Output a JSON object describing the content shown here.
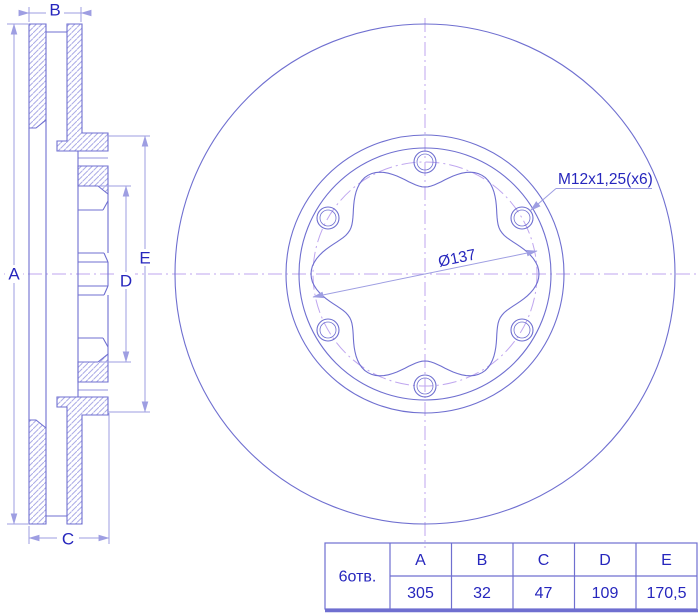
{
  "section_view": {
    "labels": {
      "a": "A",
      "b": "B",
      "c": "C",
      "d": "D",
      "e": "E"
    }
  },
  "front_view": {
    "thread_annotation": "M12x1,25(x6)",
    "bore_diameter": "Ø137"
  },
  "table": {
    "holes_label": "6отв.",
    "columns": [
      "A",
      "B",
      "C",
      "D",
      "E"
    ],
    "values": [
      "305",
      "32",
      "47",
      "109",
      "170,5"
    ]
  },
  "colors": {
    "bg": "#ffffff",
    "line": "#6f6fd0",
    "hatch": "#ababe6",
    "dim": "#9e9ee2",
    "center": "#bfa6ef",
    "text": "#2626bd",
    "table_border": "#6f6fd0"
  }
}
